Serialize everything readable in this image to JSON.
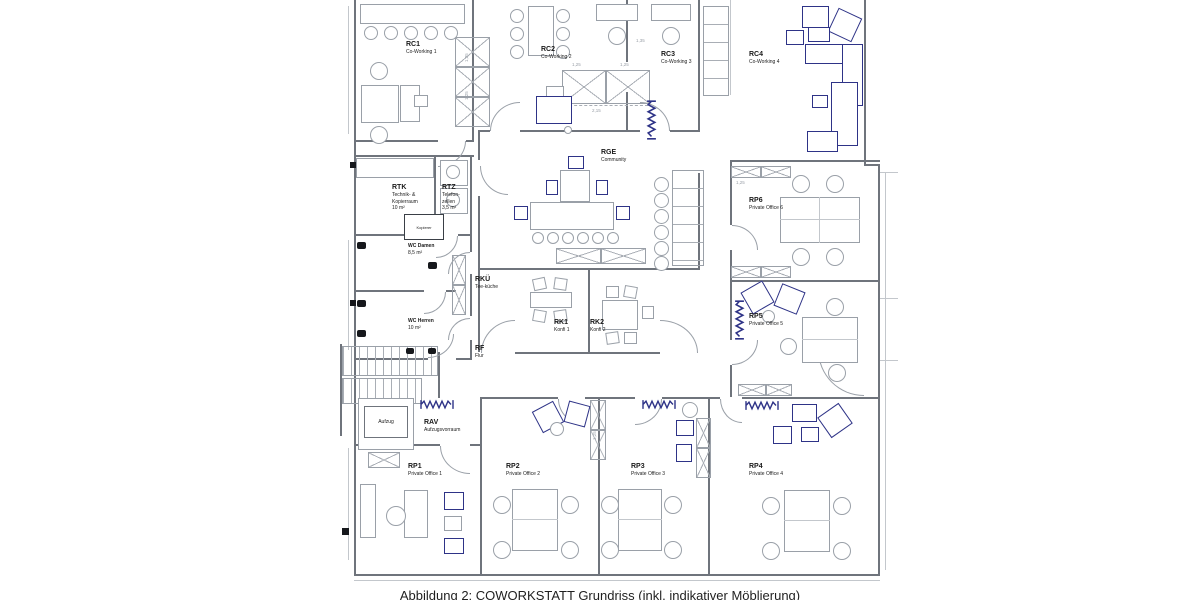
{
  "figure": {
    "caption": "Abbildung 2: COWORKSTATT Grundriss (inkl. indikativer Möblierung)"
  },
  "plan": {
    "rooms": {
      "rc1": {
        "id": "RC1",
        "name": "Co-Working 1"
      },
      "rc2": {
        "id": "RC2",
        "name": "Co-Working 2"
      },
      "rc3": {
        "id": "RC3",
        "name": "Co-Working 3"
      },
      "rc4": {
        "id": "RC4",
        "name": "Co-Working 4"
      },
      "rge": {
        "id": "RGE",
        "name": "Community"
      },
      "rtk": {
        "id": "RTK",
        "name": "Technik- & Kopierraum",
        "area": "10 m²"
      },
      "rtz": {
        "id": "RTZ",
        "name": "Telefon-zellen",
        "area": "3,5 m²"
      },
      "wc_damen": {
        "id": "WC Damen",
        "area": "8,5 m²"
      },
      "wc_herren": {
        "id": "WC Herren",
        "area": "10 m²"
      },
      "rkue": {
        "id": "RKÜ",
        "name": "Tee-küche"
      },
      "rk1": {
        "id": "RK1",
        "name": "Konfi 1"
      },
      "rk2": {
        "id": "RK2",
        "name": "Konfi 2"
      },
      "rf": {
        "id": "RF",
        "name": "Flur"
      },
      "rav": {
        "id": "RAV",
        "name": "Aufzugsvorraum"
      },
      "rp1": {
        "id": "RP1",
        "name": "Private Office 1"
      },
      "rp2": {
        "id": "RP2",
        "name": "Private Office 2"
      },
      "rp3": {
        "id": "RP3",
        "name": "Private Office 3"
      },
      "rp4": {
        "id": "RP4",
        "name": "Private Office 4"
      },
      "rp5": {
        "id": "RP5",
        "name": "Private Office 5"
      },
      "rp6": {
        "id": "RP6",
        "name": "Private Office 6"
      }
    },
    "fixtures": {
      "aufzug": "Aufzug",
      "kopierer": "Kopierer"
    },
    "dims": [
      "1,25",
      "1,25",
      "1,25",
      "1,25",
      "2,15",
      "1,35",
      "1,25",
      "1,25"
    ],
    "colors": {
      "furniture_accent": "#2e3387",
      "wall": "#6f747c",
      "line": "#9aa0a8",
      "text": "#1a1a1a"
    }
  }
}
